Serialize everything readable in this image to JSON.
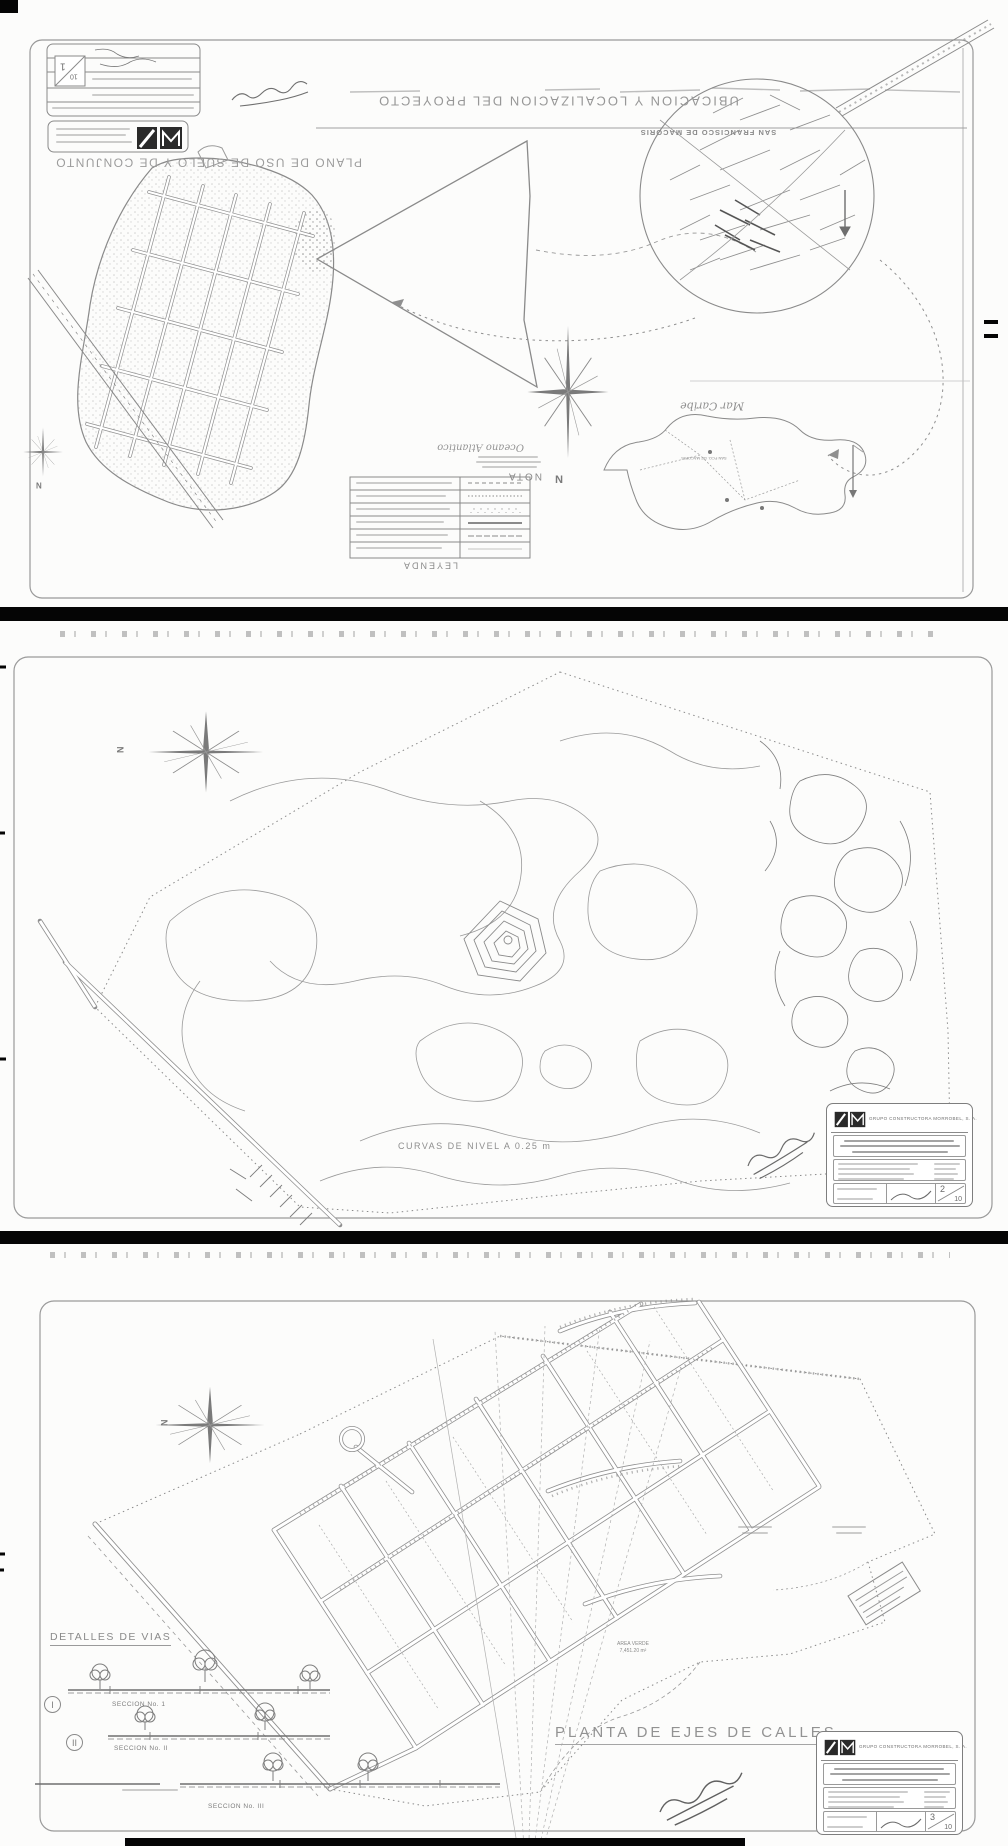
{
  "colors": {
    "paper": "#fcfcfb",
    "line": "#8a8a8a",
    "ink": "#6f6f6f",
    "separator": "#050505"
  },
  "panel1": {
    "main_title": "UBICACION  Y  LOCALIZACION  DEL  PROYECTO",
    "city_label": "SAN FRANCISCO DE MACORIS",
    "plan_title": "PLANO DE USO DE SUELO Y DE CONJUNTO",
    "sea_label": "Mar Caribe",
    "ocean_label": "Oceano Atlantico",
    "nota_label": "NOTA",
    "leyenda_label": "LEYENDA",
    "map_city_label": "SAN FCO. DE MACORIS",
    "compass_n": "N",
    "small_compass_n": "N",
    "sheet_no": "1",
    "sheet_total": "10"
  },
  "panel2": {
    "caption": "CURVAS DE NIVEL A 0.25 m",
    "compass_n": "N",
    "title_block": {
      "company": "GRUPO CONSTRUCTORA MORROBEL, S. A.",
      "sheet_no": "2",
      "sheet_total": "10"
    }
  },
  "panel3": {
    "details_title": "DETALLES DE VIAS",
    "section1": {
      "numeral": "I",
      "label": "SECCION No. 1"
    },
    "section2": {
      "numeral": "II",
      "label": "SECCION No. II"
    },
    "section3": {
      "label": "SECCION No. III"
    },
    "area_label": {
      "line1": "AREA VERDE",
      "line2": "7,451.20 m²"
    },
    "main_title": "PLANTA DE EJES DE CALLES",
    "compass_n": "N",
    "title_block": {
      "company": "GRUPO CONSTRUCTORA MORROBEL, S. A.",
      "sheet_no": "3",
      "sheet_total": "10"
    }
  }
}
